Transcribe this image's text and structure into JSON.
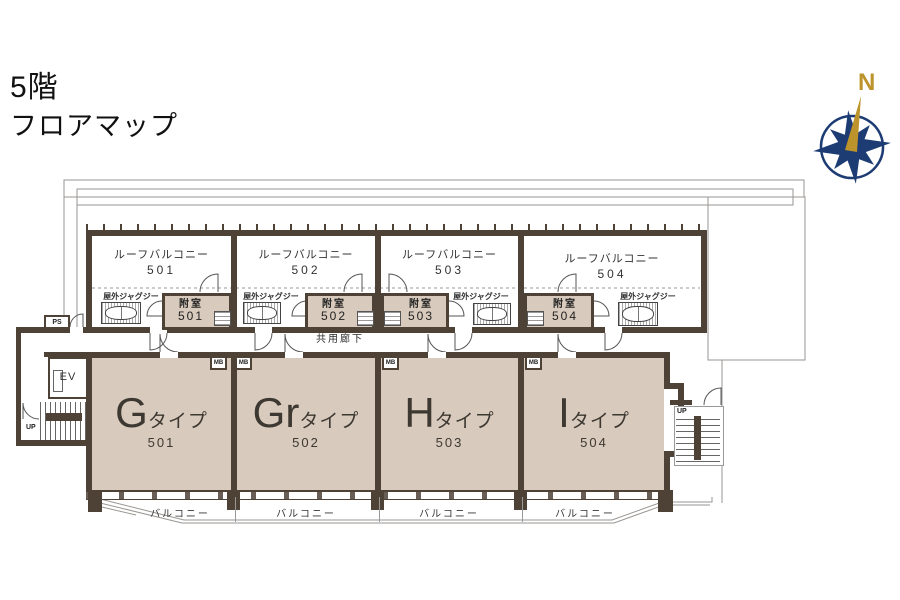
{
  "page": {
    "floor": "5階",
    "map_title": "フロアマップ"
  },
  "compass": {
    "north": "N"
  },
  "plan": {
    "corridor": "共用廊下",
    "labels": {
      "ps": "PS",
      "ev": "EV",
      "up": "UP",
      "mb": "MB"
    },
    "units": [
      {
        "roof_name": "ルーフバルコニー",
        "roof_no": "501",
        "jacuzzi": "屋外ジャグジー",
        "annex": "附室",
        "annex_no": "501",
        "type_letter": "G",
        "type_word": "タイプ",
        "unit_no": "501",
        "balcony": "バルコニー"
      },
      {
        "roof_name": "ルーフバルコニー",
        "roof_no": "502",
        "jacuzzi": "屋外ジャグジー",
        "annex": "附室",
        "annex_no": "502",
        "type_letter": "Gr",
        "type_word": "タイプ",
        "unit_no": "502",
        "balcony": "バルコニー"
      },
      {
        "roof_name": "ルーフバルコニー",
        "roof_no": "503",
        "jacuzzi": "屋外ジャグジー",
        "annex": "附室",
        "annex_no": "503",
        "type_letter": "H",
        "type_word": "タイプ",
        "unit_no": "503",
        "balcony": "バルコニー"
      },
      {
        "roof_name": "ルーフバルコニー",
        "roof_no": "504",
        "jacuzzi": "屋外ジャグジー",
        "annex": "附室",
        "annex_no": "504",
        "type_letter": "I",
        "type_word": "タイプ",
        "unit_no": "504",
        "balcony": "バルコニー"
      }
    ]
  },
  "colors": {
    "wall": "#4e4237",
    "room_fill": "#d8cabc",
    "outline": "#9a9692",
    "compass_star": "#1d3c74",
    "compass_gold": "#bd932b"
  }
}
